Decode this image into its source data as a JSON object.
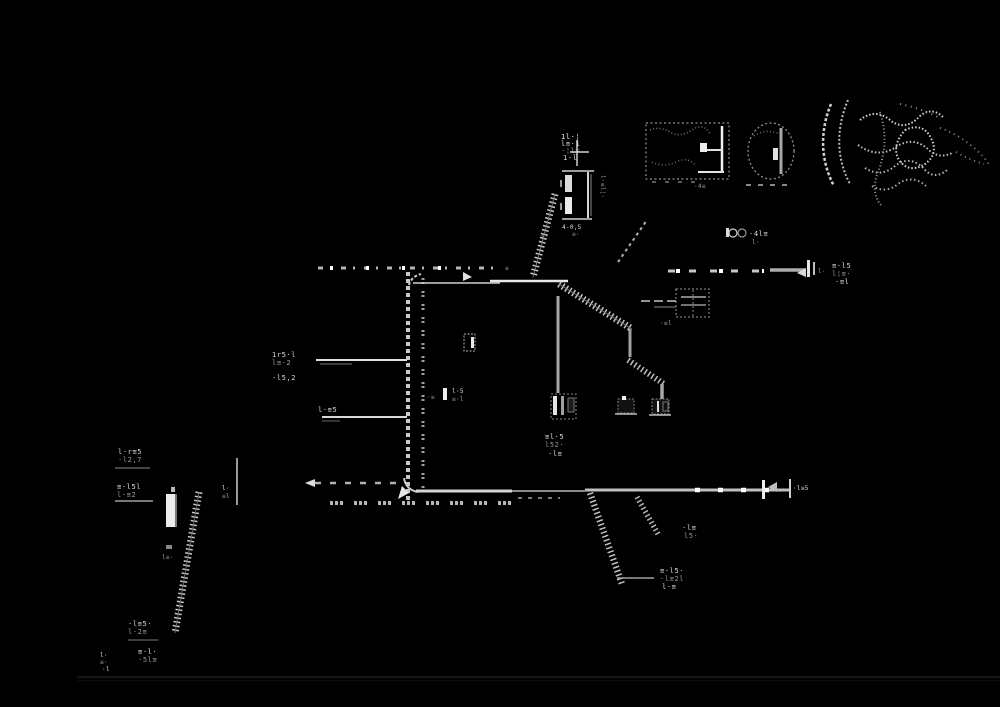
{
  "colors": {
    "background": "#000000",
    "ink_bright": "#e8e8e8",
    "ink_mid": "#bdbdbd",
    "ink_grey": "#999999",
    "ink_dim": "#6e6e6e",
    "rule_faint": "#151515"
  },
  "labels": {
    "top_cluster": [
      "1l·¦",
      "l≡·1",
      "·¦l=",
      "1·l"
    ],
    "top_comp_side": "l·≡l¦·",
    "top_comp_bottom": "4-0,5",
    "top_comp_foot": "≡·",
    "arrow_mark": "«·",
    "eq_mark": "≡",
    "box_a_label": "·4≡",
    "pair_circles_label": [
      "·4l≡",
      "l·"
    ],
    "mid_end_tick": "l·",
    "mid_end_label": [
      "≡·l5",
      "l¦≡·",
      "·≡l"
    ],
    "switch_stub_label": "·≡l",
    "m1_label": [
      "≡l·5",
      "l52·",
      "·l≡"
    ],
    "interior_label": [
      "l·5",
      "≡·l"
    ],
    "interior_tick": "·≡",
    "left_stub1_label": [
      "1r5·l",
      "l≡·2"
    ],
    "left_stub1_label2": "·l5,2",
    "left_stub2_label": "l·≡5",
    "end_label": "·l≡5",
    "bl_block1": [
      "l·r≡5",
      "·l2,7"
    ],
    "bl_block2": [
      "≡·l5l",
      "l·≡2"
    ],
    "bl_ticks": [
      "l·",
      "≡l"
    ],
    "bl_mid": "l≡·",
    "bottom_block1": [
      "·l≡5·",
      "l·2≡"
    ],
    "bottom_block2": [
      "≡·l·",
      "·5l≡"
    ],
    "bottom_block3": [
      "l·",
      "≡·",
      "·l"
    ],
    "hz_label1": [
      "·l≡",
      "l5·"
    ],
    "hz_label2": [
      "≡·l5·",
      "·l≡2l",
      "l·≡"
    ]
  }
}
